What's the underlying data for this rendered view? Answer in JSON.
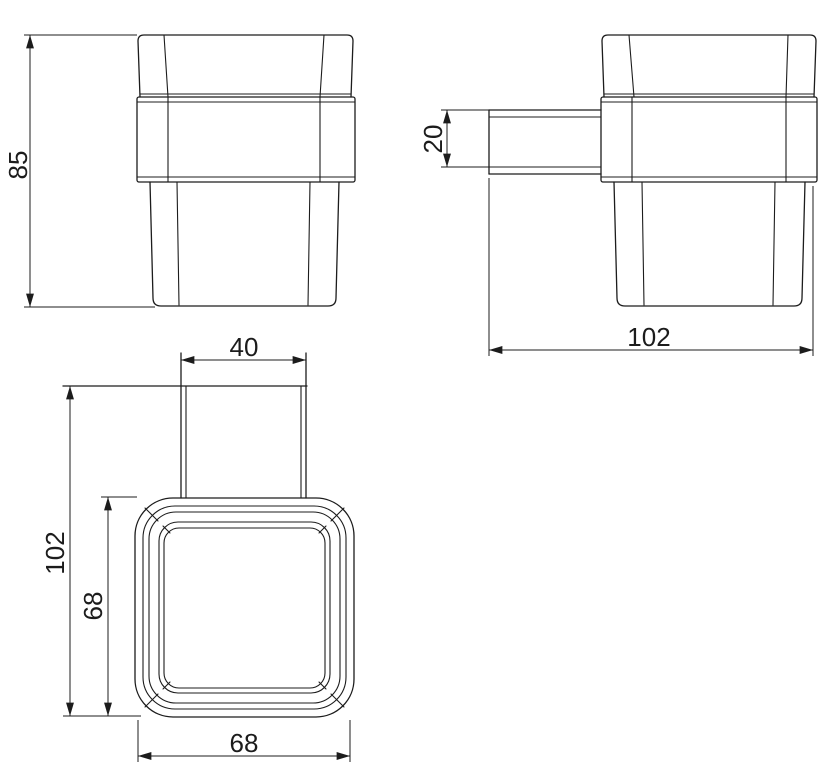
{
  "drawing": {
    "type": "technical-dimension-drawing",
    "subject": "wall-mounted square tumbler holder (front, side and plan views)",
    "views": {
      "front": {
        "name": "front view",
        "height_dim": "85"
      },
      "side": {
        "name": "side view",
        "bracket_thickness_dim": "20",
        "depth_dim": "102"
      },
      "plan": {
        "name": "plan view",
        "bracket_width_dim": "40",
        "overall_depth_dim": "102",
        "body_depth_dim": "68",
        "body_width_dim": "68"
      }
    },
    "colors": {
      "line": "#1c1c1c",
      "background": "#ffffff"
    }
  }
}
